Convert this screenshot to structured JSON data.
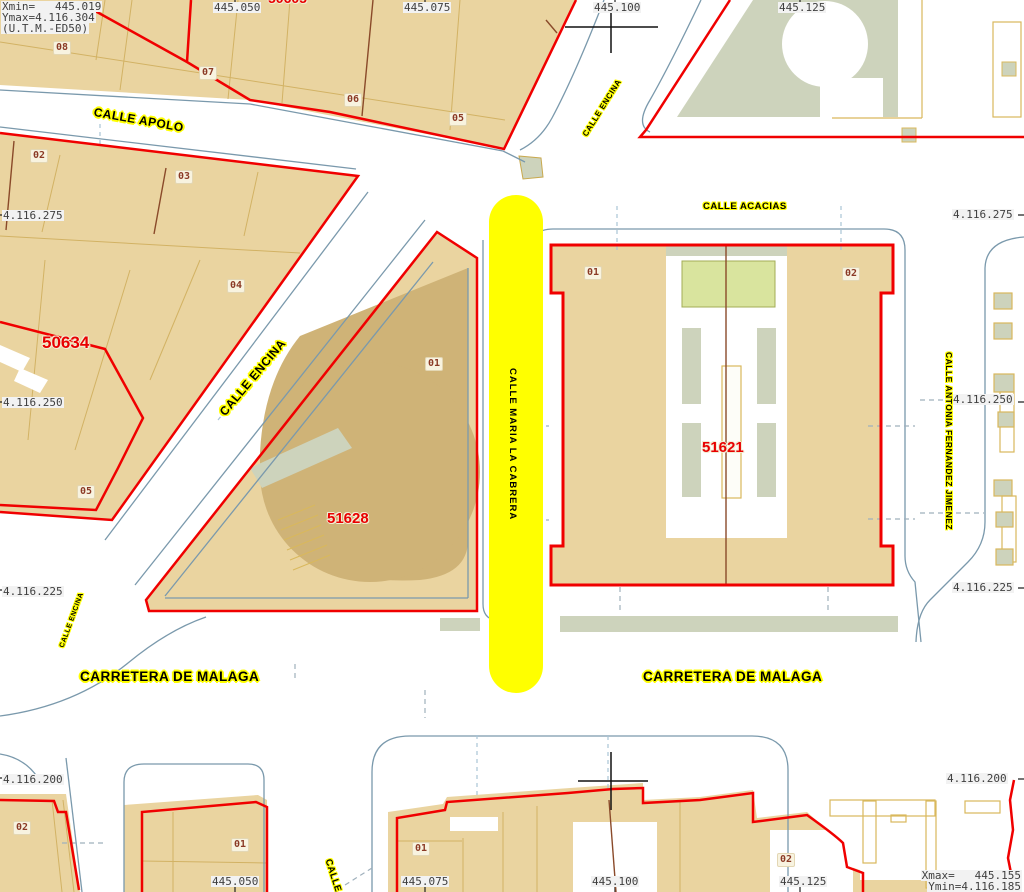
{
  "map_title": "Cadastral map sheet (U.T.M.-ED50)",
  "corner_tl": {
    "xmin": "Xmin=   445.019",
    "ymax": "Ymax=4.116.304",
    "datum": "(U.T.M.-ED50)"
  },
  "corner_br": {
    "xmax": "Xmax=   445.155",
    "ymin": "Ymin=4.116.185"
  },
  "grid": {
    "eastings": [
      "445.050",
      "445.075",
      "445.100",
      "445.125"
    ],
    "northings": [
      "4.116.275",
      "4.116.250",
      "4.116.225",
      "4.116.200"
    ]
  },
  "streets": {
    "apolo": "CALLE APOLO",
    "encina": "CALLE ENCINA",
    "acacias": "CALLE ACACIAS",
    "maria_la_cabrera": "CALLE MARIA LA CABRERA",
    "antonia": "CALLE ANTONIA FERNANDEZ JIMENEZ",
    "carretera": "CARRETERA DE MALAGA",
    "clipped_south": "CALLE"
  },
  "blocks": {
    "west": "50634",
    "triangle": "51628",
    "east": "51621",
    "clipped_top": "50605"
  },
  "parcels": {
    "strip": [
      "08",
      "07",
      "06",
      "05"
    ],
    "west": [
      "02",
      "03",
      "04",
      "05"
    ],
    "triangle": [
      "01"
    ],
    "east": [
      "01",
      "02"
    ],
    "south": [
      "02",
      "01",
      "01",
      "02"
    ]
  },
  "colors": {
    "building": "#EAD4A0",
    "building_dark": "#CFB377",
    "parcel_line": "#D2B264",
    "hollow_outline": "#D9B85C",
    "boundary_red": "#F00000",
    "curb_blue": "#7A99AC",
    "green_area": "#CDD3BC",
    "courtyard_green": "#D9E49E",
    "highlight_yellow": "#FFFF00",
    "block_text_red": "#E80000",
    "parcel_text": "#8B3A26"
  }
}
